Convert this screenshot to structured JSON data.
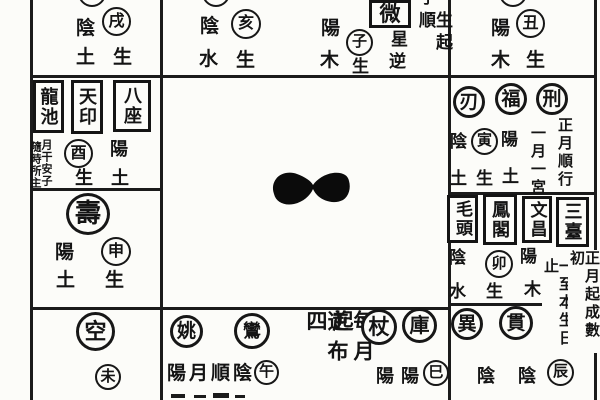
{
  "top_row": {
    "xu": {
      "yinyang": "陰",
      "branch": "戌",
      "element": "土",
      "sheng": "生"
    },
    "hai": {
      "yinyang": "陰",
      "branch": "亥",
      "element": "水",
      "sheng": "生"
    },
    "zi": {
      "yinyang": "陽",
      "branch": "子",
      "element": "木",
      "sheng": "生",
      "boxed_star": "微",
      "note_inner_top": "星",
      "note_inner_bottom": "逆",
      "note_outer": "生起順",
      "note_outer_cut": "子"
    },
    "chou": {
      "yinyang": "陽",
      "branch": "丑",
      "element": "木",
      "sheng": "生"
    }
  },
  "left_column": {
    "you_cell": {
      "boxed_stars": [
        "龍池",
        "天印",
        "八座"
      ],
      "micro_note_inner": "月干安子",
      "micro_note_outer": "隨時所主",
      "branch": "酉",
      "sheng": "生",
      "yinyang": "陽",
      "element": "土"
    },
    "shen_cell": {
      "circled_star": "壽",
      "yinyang": "陽",
      "branch": "申",
      "element": "土",
      "sheng": "生"
    },
    "wei_cell": {
      "circled_star": "空",
      "branch": "未"
    }
  },
  "right_column": {
    "yin_cell": {
      "circled_stars": [
        "刃",
        "福",
        "刑"
      ],
      "yinyang_left": "陰",
      "branch": "寅",
      "yinyang_right": "陽",
      "element_left": "土",
      "sheng": "生",
      "element_right": "土",
      "note_inner": "一月一宮",
      "note_outer": "正月順行"
    },
    "mao_cell": {
      "boxed_stars": [
        "毛頭",
        "鳳閣",
        "文昌",
        "三臺"
      ],
      "yinyang_left": "陰",
      "branch": "卯",
      "yinyang_right": "陽",
      "element_left": "水",
      "sheng": "生",
      "element_right": "木",
      "note_inner": "一至本生日止",
      "note_outer": "正月起成數初"
    }
  },
  "bottom_row": {
    "wu_cell": {
      "circled_stars": [
        "姚",
        "鸞"
      ],
      "note": "陽月順陰",
      "branch": "午"
    },
    "si_cell": {
      "note_outer": "每月起",
      "note_inner": "逆布四",
      "circled_stars": [
        "杖",
        "庫"
      ],
      "yinyang_pair": [
        "陽",
        "陽"
      ],
      "branch": "巳"
    },
    "chen_cell": {
      "circled_stars": [
        "異",
        "貫"
      ],
      "yinyang_pair": [
        "陰",
        "陰"
      ],
      "branch": "辰"
    }
  }
}
